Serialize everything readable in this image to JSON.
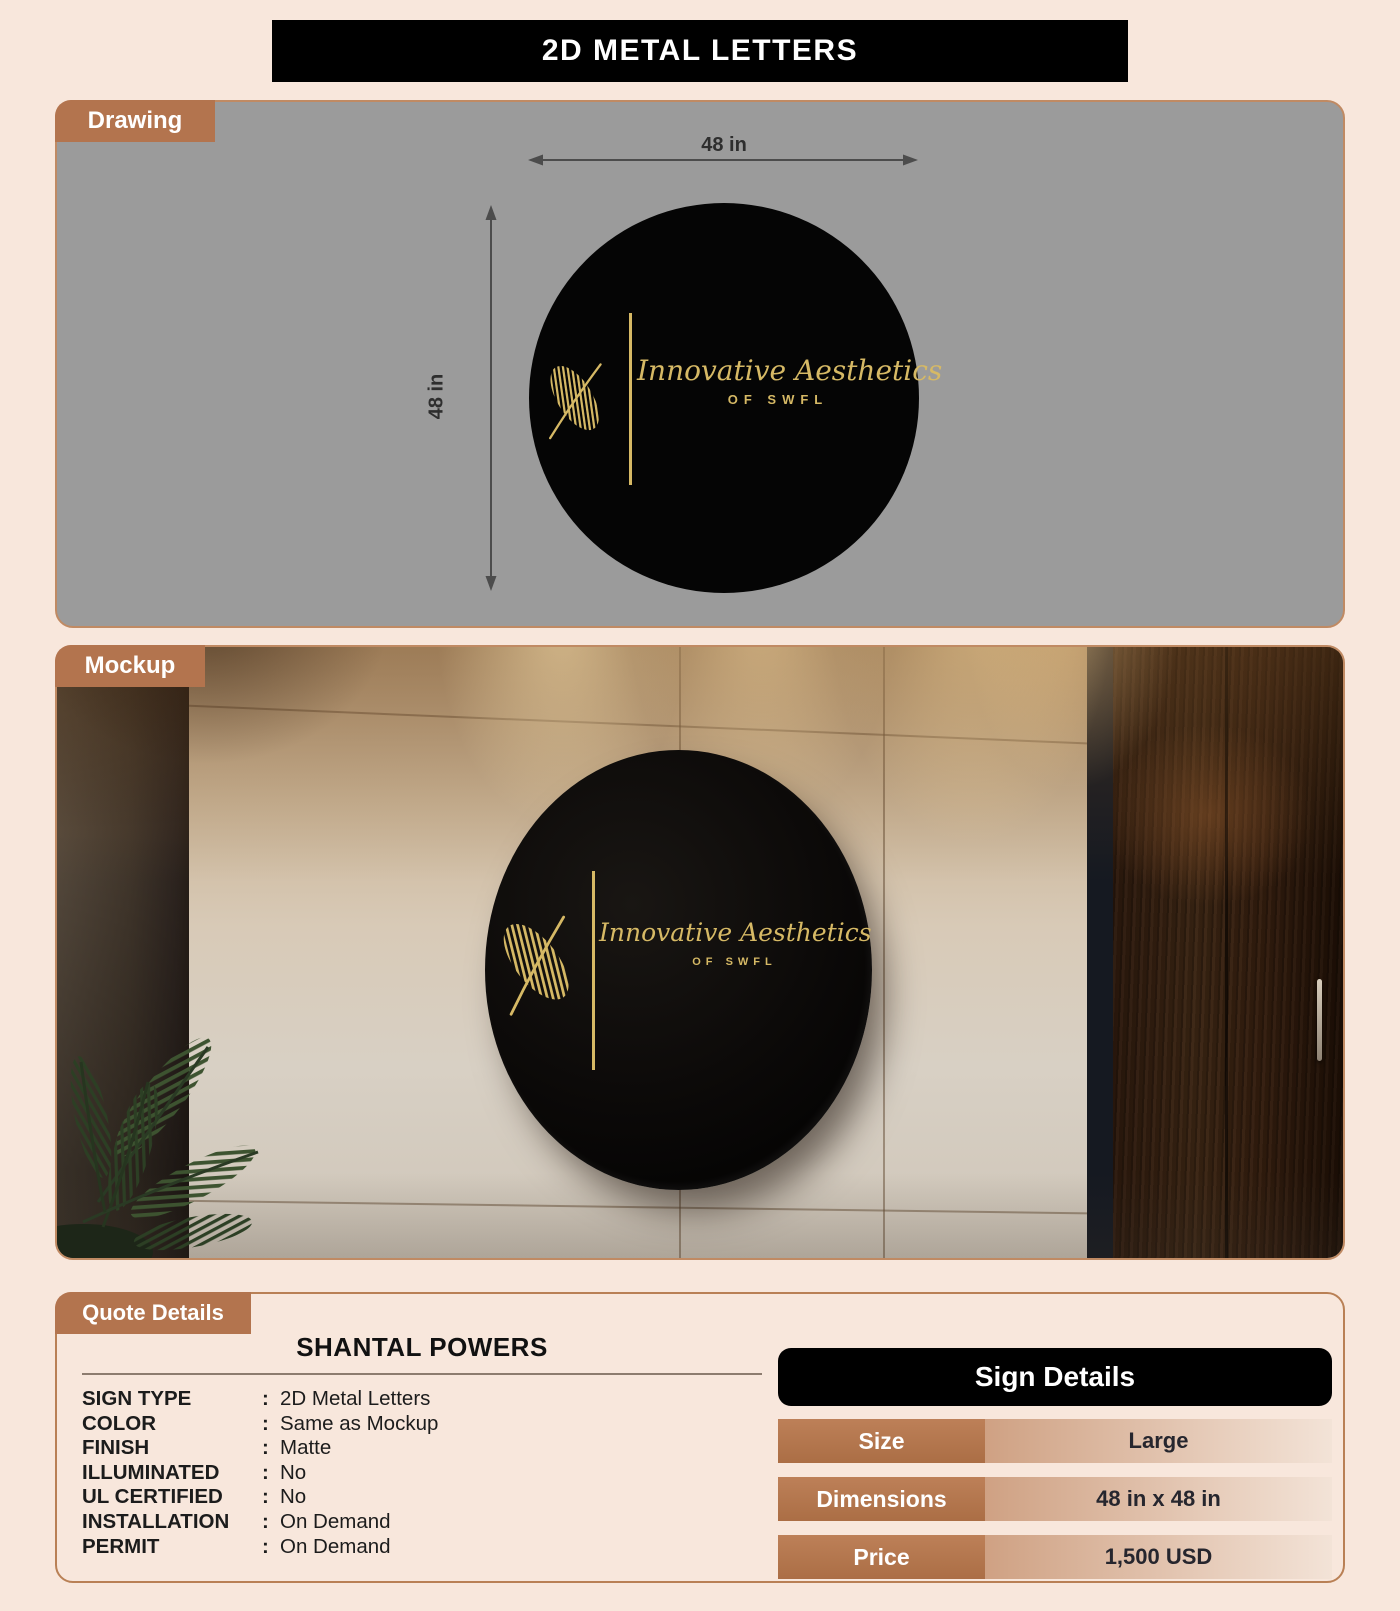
{
  "title": "2D METAL LETTERS",
  "tabs": {
    "drawing": "Drawing",
    "mockup": "Mockup",
    "quote": "Quote Details"
  },
  "drawing": {
    "width_dim": "48 in",
    "height_dim": "48 in"
  },
  "logo": {
    "brand": "Innovative Aesthetics",
    "sub": "OF SWFL"
  },
  "quote": {
    "customer": "SHANTAL POWERS",
    "fields": [
      {
        "label": "SIGN TYPE",
        "sep": ":",
        "value": "2D Metal Letters"
      },
      {
        "label": "COLOR",
        "sep": ":",
        "value": "Same as Mockup"
      },
      {
        "label": "FINISH",
        "sep": ":",
        "value": "Matte"
      },
      {
        "label": "ILLUMINATED",
        "sep": ":",
        "value": "No"
      },
      {
        "label": "UL CERTIFIED",
        "sep": ":",
        "value": "No"
      },
      {
        "label": "INSTALLATION",
        "sep": ":",
        "value": "On Demand"
      },
      {
        "label": "PERMIT",
        "sep": ":",
        "value": "On Demand"
      }
    ]
  },
  "sign_details": {
    "title": "Sign Details",
    "rows": [
      {
        "label": "Size",
        "value": "Large"
      },
      {
        "label": "Dimensions",
        "value": "48 in x 48 in"
      },
      {
        "label": "Price",
        "value": "1,500 USD"
      }
    ]
  },
  "colors": {
    "page_bg": "#f8e7dc",
    "accent_brown": "#b3744e",
    "gold": "#d6b965",
    "header_black": "#000000",
    "drawing_bg": "#9b9b9b"
  }
}
